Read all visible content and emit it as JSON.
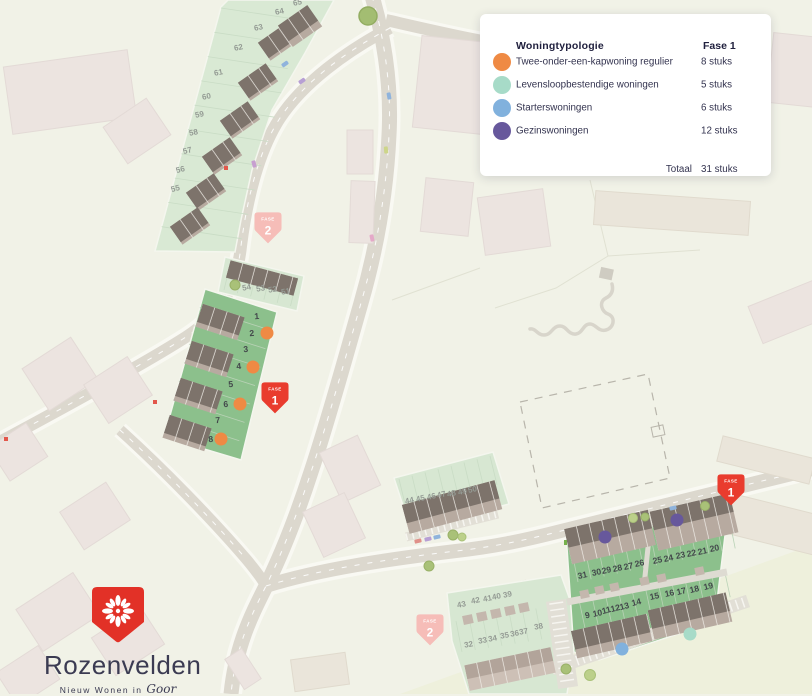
{
  "colors": {
    "orange": "#ef8a44",
    "teal": "#a7dbc8",
    "blue": "#81b1dd",
    "purple": "#67589c",
    "fase1_pin": "#e93c2e",
    "fase2_pin": "#f6bdb8"
  },
  "legend": {
    "title": "Woningtypologie",
    "phase_label": "Fase 1",
    "rows": [
      {
        "label": "Twee-onder-een-kapwoning regulier",
        "count": "8 stuks",
        "color_key": "orange"
      },
      {
        "label": "Levensloopbestendige woningen",
        "count": "5 stuks",
        "color_key": "teal"
      },
      {
        "label": "Starterswoningen",
        "count": "6 stuks",
        "color_key": "blue"
      },
      {
        "label": "Gezinswoningen",
        "count": "12 stuks",
        "color_key": "purple"
      }
    ],
    "total_label": "Totaal",
    "total_count": "31 stuks"
  },
  "logo": {
    "name": "Rozenvelden",
    "tagline_prefix": "Nieuw Wonen in",
    "tagline_place": "Goor"
  },
  "pins": [
    {
      "cls": "fase1",
      "top": "FASE",
      "num": "1",
      "x": 275,
      "y": 394
    },
    {
      "cls": "fase1",
      "top": "FASE",
      "num": "1",
      "x": 731,
      "y": 486
    },
    {
      "cls": "fase2",
      "top": "FASE",
      "num": "2",
      "x": 268,
      "y": 224
    },
    {
      "cls": "fase2",
      "top": "FASE",
      "num": "2",
      "x": 430,
      "y": 626
    }
  ],
  "map": {
    "plot_labels": [
      {
        "n": "1",
        "x": 257,
        "y": 319,
        "r": -5,
        "p": 1
      },
      {
        "n": "2",
        "x": 252,
        "y": 336,
        "r": -5,
        "p": 1
      },
      {
        "n": "3",
        "x": 246,
        "y": 352,
        "r": -5,
        "p": 1
      },
      {
        "n": "4",
        "x": 239,
        "y": 369,
        "r": -5,
        "p": 1
      },
      {
        "n": "5",
        "x": 231,
        "y": 387,
        "r": -5,
        "p": 1
      },
      {
        "n": "6",
        "x": 226,
        "y": 407,
        "r": -5,
        "p": 1
      },
      {
        "n": "7",
        "x": 218,
        "y": 423,
        "r": -5,
        "p": 1
      },
      {
        "n": "8",
        "x": 211,
        "y": 442,
        "r": -5,
        "p": 1
      },
      {
        "n": "31",
        "x": 583,
        "y": 578,
        "r": -12,
        "p": 1
      },
      {
        "n": "30",
        "x": 597,
        "y": 575,
        "r": -12,
        "p": 1
      },
      {
        "n": "29",
        "x": 607,
        "y": 573,
        "r": -12,
        "p": 1
      },
      {
        "n": "28",
        "x": 618,
        "y": 571,
        "r": -12,
        "p": 1
      },
      {
        "n": "27",
        "x": 629,
        "y": 569,
        "r": -12,
        "p": 1
      },
      {
        "n": "26",
        "x": 640,
        "y": 566,
        "r": -12,
        "p": 1
      },
      {
        "n": "25",
        "x": 658,
        "y": 563,
        "r": -12,
        "p": 1
      },
      {
        "n": "24",
        "x": 669,
        "y": 561,
        "r": -12,
        "p": 1
      },
      {
        "n": "23",
        "x": 681,
        "y": 558,
        "r": -12,
        "p": 1
      },
      {
        "n": "22",
        "x": 692,
        "y": 556,
        "r": -12,
        "p": 1
      },
      {
        "n": "21",
        "x": 703,
        "y": 554,
        "r": -12,
        "p": 1
      },
      {
        "n": "20",
        "x": 715,
        "y": 551,
        "r": -12,
        "p": 1
      },
      {
        "n": "9",
        "x": 588,
        "y": 618,
        "r": -12,
        "p": 1
      },
      {
        "n": "10",
        "x": 598,
        "y": 616,
        "r": -12,
        "p": 1
      },
      {
        "n": "11",
        "x": 607,
        "y": 613,
        "r": -14,
        "p": 1
      },
      {
        "n": "12",
        "x": 616,
        "y": 611,
        "r": -14,
        "p": 1
      },
      {
        "n": "13",
        "x": 625,
        "y": 609,
        "r": -14,
        "p": 1
      },
      {
        "n": "14",
        "x": 637,
        "y": 605,
        "r": -14,
        "p": 1
      },
      {
        "n": "15",
        "x": 655,
        "y": 599,
        "r": -12,
        "p": 1
      },
      {
        "n": "16",
        "x": 670,
        "y": 596,
        "r": -12,
        "p": 1
      },
      {
        "n": "17",
        "x": 682,
        "y": 594,
        "r": -14,
        "p": 1
      },
      {
        "n": "18",
        "x": 695,
        "y": 592,
        "r": -14,
        "p": 1
      },
      {
        "n": "19",
        "x": 709,
        "y": 589,
        "r": -14,
        "p": 1
      },
      {
        "n": "55",
        "x": 176,
        "y": 191,
        "r": -14,
        "p": 2
      },
      {
        "n": "56",
        "x": 181,
        "y": 172,
        "r": -14,
        "p": 2
      },
      {
        "n": "57",
        "x": 188,
        "y": 153,
        "r": -14,
        "p": 2
      },
      {
        "n": "58",
        "x": 194,
        "y": 135,
        "r": -12,
        "p": 2
      },
      {
        "n": "59",
        "x": 200,
        "y": 117,
        "r": -12,
        "p": 2
      },
      {
        "n": "60",
        "x": 207,
        "y": 99,
        "r": -12,
        "p": 2
      },
      {
        "n": "61",
        "x": 219,
        "y": 75,
        "r": -12,
        "p": 2
      },
      {
        "n": "62",
        "x": 239,
        "y": 50,
        "r": -12,
        "p": 2
      },
      {
        "n": "63",
        "x": 259,
        "y": 30,
        "r": -12,
        "p": 2
      },
      {
        "n": "64",
        "x": 280,
        "y": 14,
        "r": -12,
        "p": 2
      },
      {
        "n": "65",
        "x": 298,
        "y": 5,
        "r": -12,
        "p": 2
      },
      {
        "n": "54",
        "x": 247,
        "y": 290,
        "r": -10,
        "p": 2
      },
      {
        "n": "53",
        "x": 261,
        "y": 291,
        "r": -10,
        "p": 2
      },
      {
        "n": "52",
        "x": 273,
        "y": 292,
        "r": -10,
        "p": 2
      },
      {
        "n": "51",
        "x": 286,
        "y": 294,
        "r": -10,
        "p": 2
      },
      {
        "n": "44",
        "x": 410,
        "y": 503,
        "r": -13,
        "p": 2
      },
      {
        "n": "45",
        "x": 421,
        "y": 501,
        "r": -13,
        "p": 2
      },
      {
        "n": "46",
        "x": 432,
        "y": 499,
        "r": -13,
        "p": 2
      },
      {
        "n": "47",
        "x": 442,
        "y": 497,
        "r": -13,
        "p": 2
      },
      {
        "n": "48",
        "x": 452,
        "y": 496,
        "r": -13,
        "p": 2
      },
      {
        "n": "49",
        "x": 463,
        "y": 494,
        "r": -13,
        "p": 2
      },
      {
        "n": "50",
        "x": 473,
        "y": 492,
        "r": -13,
        "p": 2
      },
      {
        "n": "43",
        "x": 462,
        "y": 607,
        "r": -12,
        "p": 2
      },
      {
        "n": "42",
        "x": 476,
        "y": 603,
        "r": -12,
        "p": 2
      },
      {
        "n": "41",
        "x": 488,
        "y": 601,
        "r": -12,
        "p": 2
      },
      {
        "n": "40",
        "x": 497,
        "y": 599,
        "r": -12,
        "p": 2
      },
      {
        "n": "39",
        "x": 508,
        "y": 597,
        "r": -12,
        "p": 2
      },
      {
        "n": "32",
        "x": 469,
        "y": 647,
        "r": -10,
        "p": 2
      },
      {
        "n": "33",
        "x": 483,
        "y": 643,
        "r": -10,
        "p": 2
      },
      {
        "n": "34",
        "x": 493,
        "y": 641,
        "r": -10,
        "p": 2
      },
      {
        "n": "35",
        "x": 505,
        "y": 638,
        "r": -10,
        "p": 2
      },
      {
        "n": "36",
        "x": 515,
        "y": 636,
        "r": -10,
        "p": 2
      },
      {
        "n": "37",
        "x": 524,
        "y": 634,
        "r": -10,
        "p": 2
      },
      {
        "n": "38",
        "x": 539,
        "y": 629,
        "r": -10,
        "p": 2
      }
    ],
    "dots": [
      {
        "k": "orange",
        "x": 267,
        "y": 333
      },
      {
        "k": "orange",
        "x": 253,
        "y": 367
      },
      {
        "k": "orange",
        "x": 240,
        "y": 404
      },
      {
        "k": "orange",
        "x": 221,
        "y": 439
      },
      {
        "k": "purple",
        "x": 605,
        "y": 537
      },
      {
        "k": "purple",
        "x": 677,
        "y": 520
      },
      {
        "k": "blue",
        "x": 622,
        "y": 649
      },
      {
        "k": "teal",
        "x": 690,
        "y": 634
      }
    ]
  }
}
